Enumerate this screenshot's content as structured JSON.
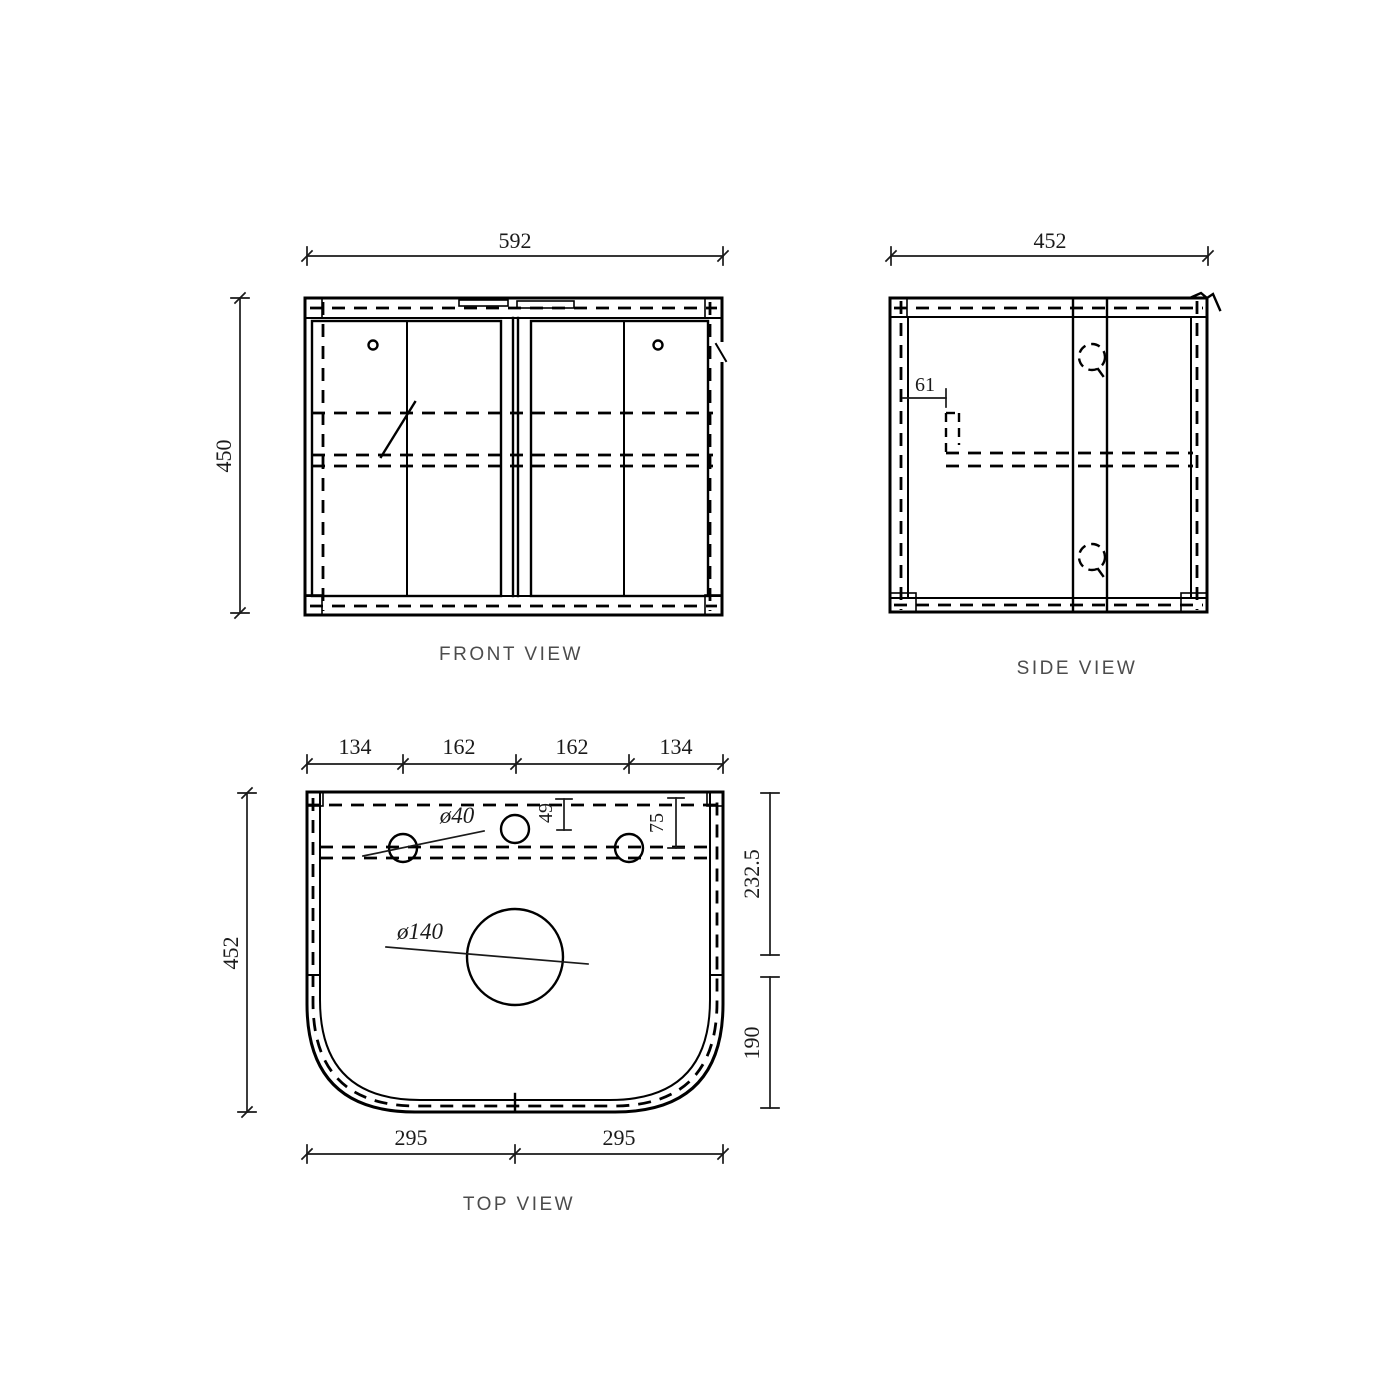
{
  "drawing": {
    "background_color": "#ffffff",
    "line_color": "#000000",
    "front": {
      "label": "FRONT VIEW",
      "width_dim": "592",
      "height_dim": "450"
    },
    "side": {
      "label": "SIDE VIEW",
      "width_dim": "452",
      "back_offset_dim": "61"
    },
    "top": {
      "label": "TOP VIEW",
      "hole_spacing_dims": [
        "134",
        "162",
        "162",
        "134"
      ],
      "depth_dim": "452",
      "center_hole_offset_dim": "49",
      "right_hole_offset_dim": "75",
      "tap_hole_dia": "ø40",
      "basin_hole_dia": "ø140",
      "upper_depth_dim": "232.5",
      "lower_depth_dim": "190",
      "door_width_dims": [
        "295",
        "295"
      ]
    }
  }
}
